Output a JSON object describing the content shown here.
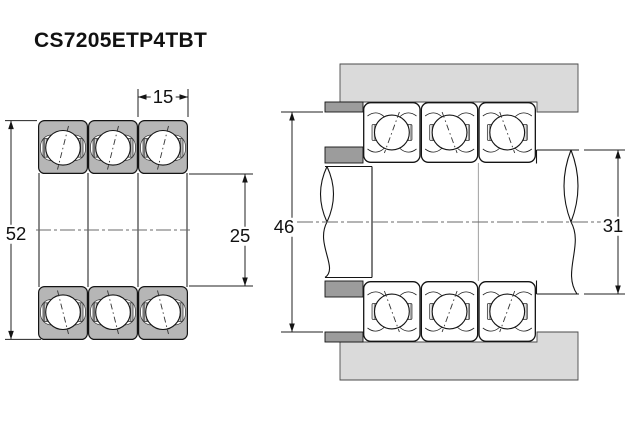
{
  "title": "CS7205ETP4TBT",
  "views": {
    "sectional": {
      "label": "bearing-set-cross-section",
      "dims": {
        "outside_diameter": "52",
        "single_bearing_width": "15",
        "bore_diameter": "25"
      }
    },
    "mounted": {
      "label": "shaft-and-housing-mounting",
      "dims": {
        "housing_abutment_diameter": "46",
        "shaft_abutment_diameter": "31"
      }
    }
  },
  "colors": {
    "housing_gray": "#dadada",
    "spacer_gray": "#9c9c9c",
    "ring_gray": "#b6b6b6",
    "line_black": "#141414"
  }
}
